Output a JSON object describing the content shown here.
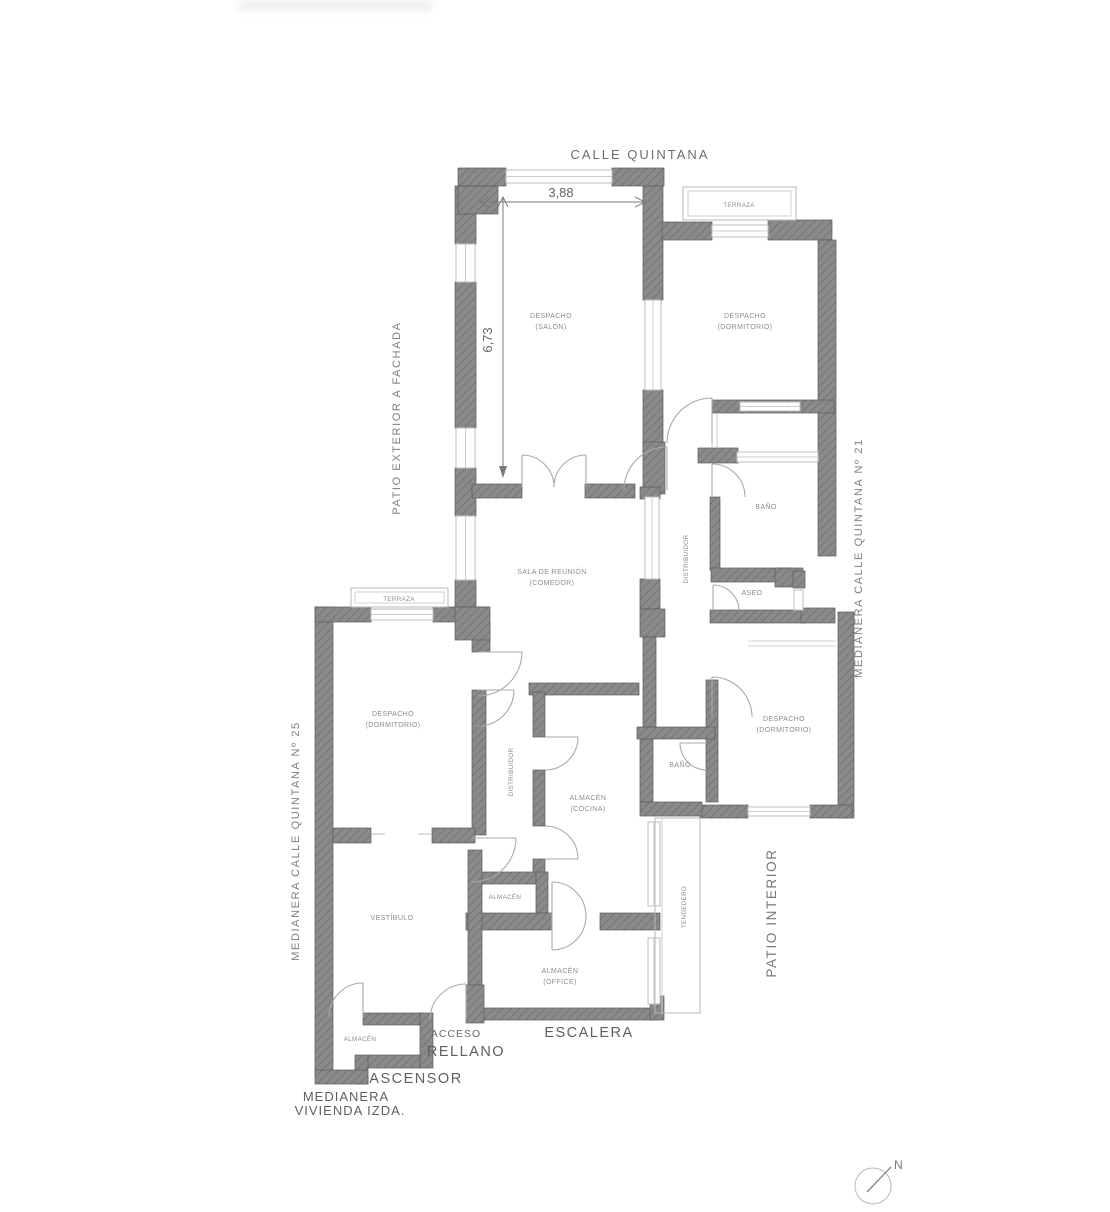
{
  "plan": {
    "street_label": "CALLE QUINTANA",
    "dimensions": {
      "width_m": "3,88",
      "depth_m": "6,73"
    },
    "boundaries": {
      "patio_exterior": "PATIO EXTERIOR A FACHADA",
      "medianera_21": "MEDIANERA CALLE QUINTANA Nº 21",
      "medianera_25": "MEDIANERA CALLE QUINTANA Nº 25",
      "patio_interior": "PATIO INTERIOR",
      "medianera_izda_line1": "MEDIANERA",
      "medianera_izda_line2": "VIVIENDA IZDA."
    },
    "common_areas": {
      "acceso": "ACCESO",
      "rellano": "RELLANO",
      "ascensor": "ASCENSOR",
      "escalera": "ESCALERA"
    },
    "rooms": {
      "salon": {
        "name": "DESPACHO",
        "sub": "(SALÓN)"
      },
      "dorm_top_right": {
        "name": "DESPACHO",
        "sub": "(DORMITORIO)"
      },
      "terraza_top_right": "TERRAZA",
      "terraza_left": "TERRAZA",
      "comedor": {
        "name": "SALA DE REUNIÓN",
        "sub": "(COMEDOR)"
      },
      "bano_right": "BAÑO",
      "aseo": "ASEO",
      "distribuidor_right": "DISTRIBUIDOR",
      "distribuidor_left": "DISTRIBUIDOR",
      "dorm_left": {
        "name": "DESPACHO",
        "sub": "(DORMITORIO)"
      },
      "dorm_right": {
        "name": "DESPACHO",
        "sub": "(DORMITORIO)"
      },
      "cocina": {
        "name": "ALMACÉN",
        "sub": "(COCINA)"
      },
      "bano_bottom": "BAÑO",
      "vestibulo": "VESTÍBULO",
      "almacen_mid": "ALMACÉN",
      "office": {
        "name": "ALMACÉN",
        "sub": "(OFFICE)"
      },
      "almacen_bottom_left": "ALMACÉN",
      "tendedero": "TENDEDERO"
    },
    "compass": {
      "north": "N"
    },
    "colors": {
      "wall": "#848484",
      "wall_edge": "#5d5d5d",
      "window": "#c9c9c9",
      "door_arc": "#aaaaaa",
      "text_light": "#8c8c8c",
      "text_dark": "#5f5f5f",
      "background": "#ffffff"
    }
  }
}
